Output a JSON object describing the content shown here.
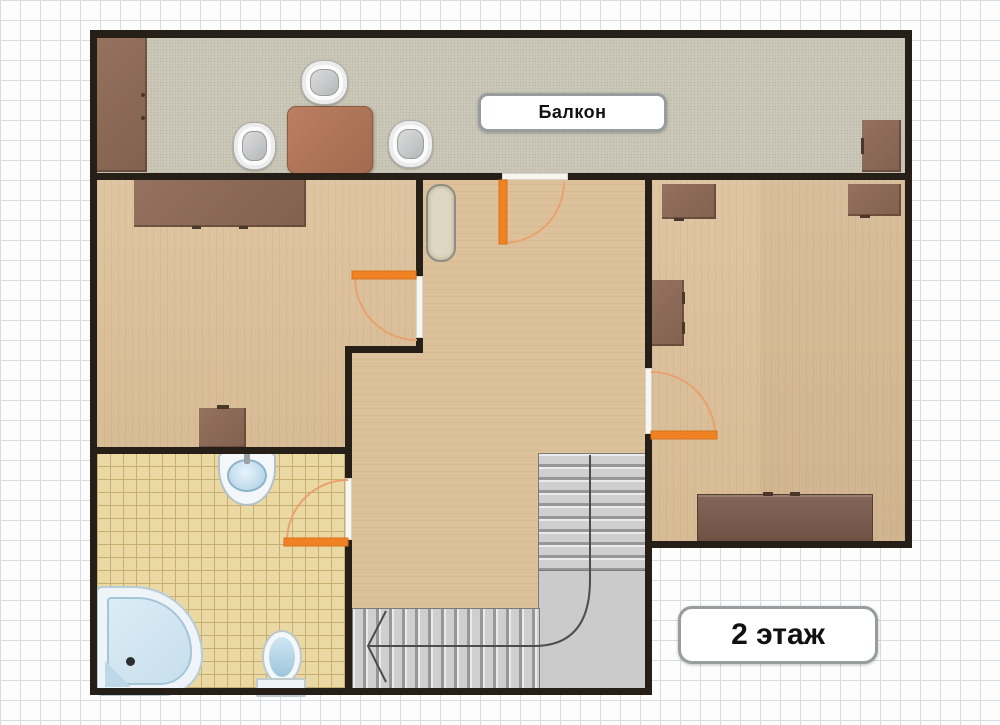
{
  "labels": {
    "balcony": "Балкон",
    "floor": "2 этаж"
  },
  "palette": {
    "wall": "#261f18",
    "wood_floor": "#ddc29c",
    "balcony_floor": "#cdc9ba",
    "bathroom_tile": "#ebd9a3",
    "tile_line": "#c9ae74",
    "door_leaf_orange": "#f08223",
    "door_arc_orange": "#e9a26e",
    "stair_gray": "#cfcfcf",
    "furniture_brown": "#8a675a",
    "bedding_beige": "#d3cdbc",
    "fixture_blue": "#c7dfec",
    "label_border": "#979d9e",
    "grid_line": "#d9dce0"
  }
}
